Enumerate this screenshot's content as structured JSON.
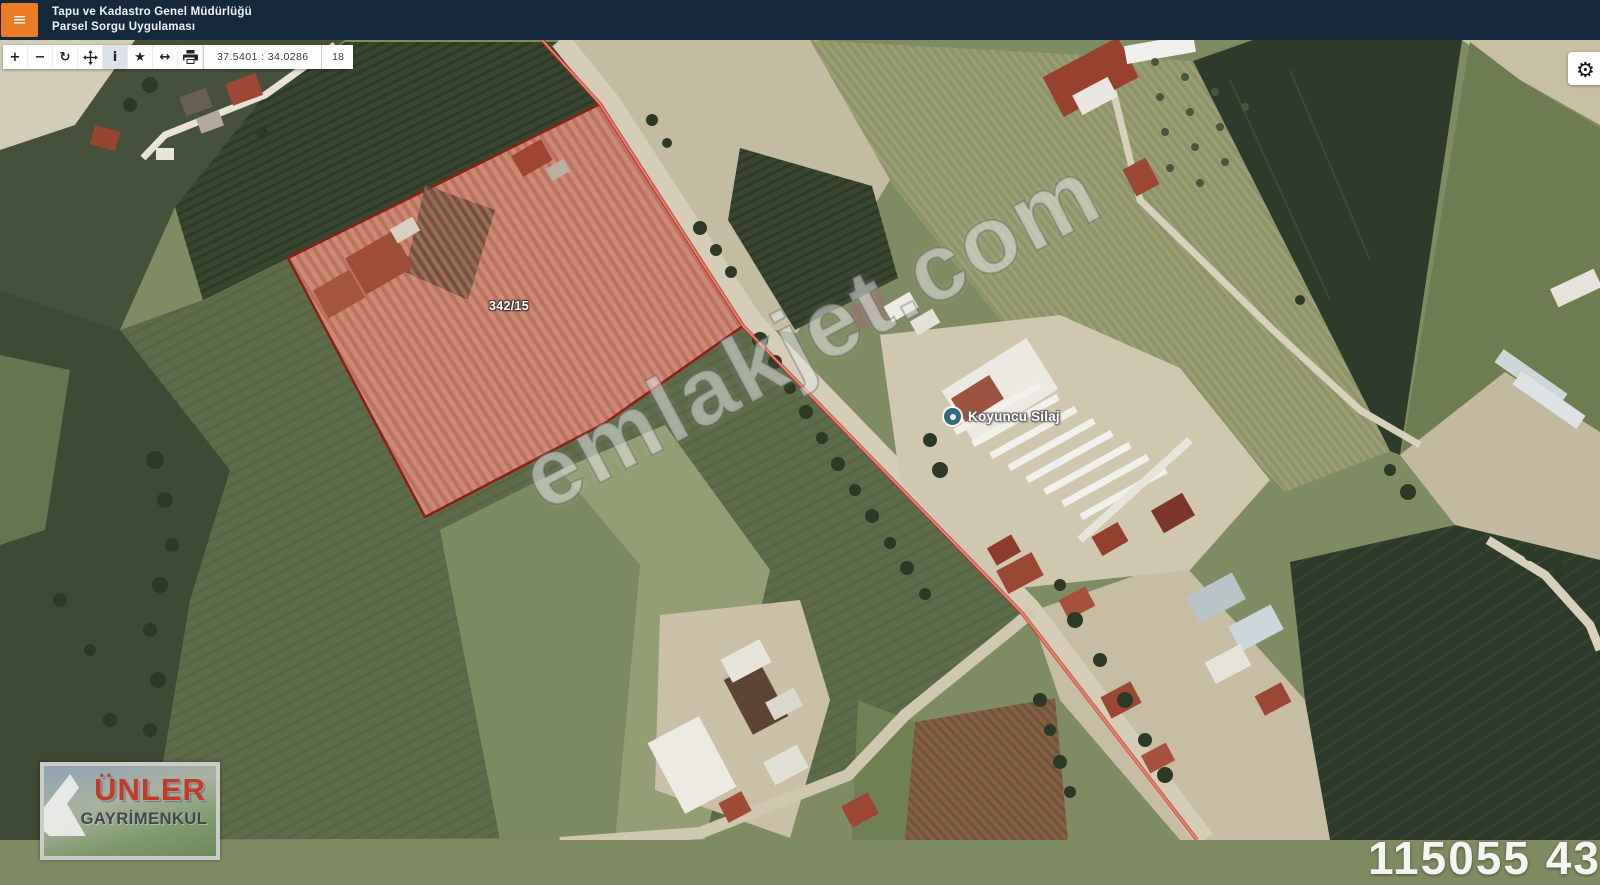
{
  "header": {
    "title_line1": "Tapu ve Kadastro Genel Müdürlüğü",
    "title_line2": "Parsel Sorgu Uygulaması",
    "bar_color": "#16293c",
    "menu_button_color": "#ec7b26",
    "menu_glyph": "≡"
  },
  "toolbar": {
    "buttons": [
      {
        "name": "zoom-in",
        "glyph": "+"
      },
      {
        "name": "zoom-out",
        "glyph": "−"
      },
      {
        "name": "refresh",
        "glyph": "↻"
      },
      {
        "name": "pan",
        "glyph": ""
      },
      {
        "name": "info",
        "glyph": "i",
        "active": true
      },
      {
        "name": "favorite",
        "glyph": "★"
      },
      {
        "name": "measure",
        "glyph": "↔"
      },
      {
        "name": "print",
        "glyph": ""
      }
    ],
    "coordinates": "37.5401 : 34.0286",
    "zoom_level": "18"
  },
  "settings": {
    "glyph": "⚙"
  },
  "map": {
    "parcel": {
      "label": "342/15",
      "outline_color": "#8e1d15",
      "fill_tint": "rgba(200,55,45,0.17)"
    },
    "boundary_line_color": "#e05545",
    "poi": {
      "label": "Koyuncu Silaj",
      "icon_color": "#2f6b7c"
    },
    "watermark": "emlakjet.com",
    "partial_listing_number": "115055 431"
  },
  "logo": {
    "line1": "ÜNLER",
    "line2": "GAYRİMENKUL",
    "accent_color": "#c5392b",
    "secondary_color": "#3e474d"
  }
}
